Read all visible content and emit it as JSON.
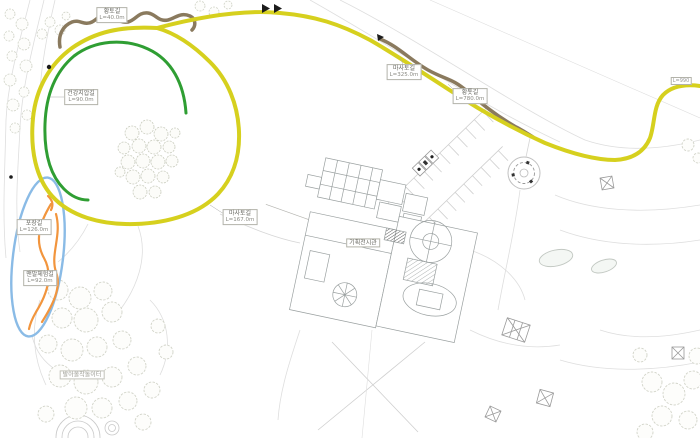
{
  "map": {
    "type": "park-trail-site-plan",
    "colors": {
      "trail_yellow": "#d6d01e",
      "trail_green": "#2f9e33",
      "trail_brown": "#8a7a5e",
      "trail_orange": "#f2953d",
      "track_blue": "#8abbe6"
    },
    "trails": [
      {
        "name": "황토길",
        "length": "L=40.0m"
      },
      {
        "name": "마사토길",
        "length": "L=325.0m"
      },
      {
        "name": "황톳길",
        "length": "L=780.0m"
      },
      {
        "name": "건강지압길",
        "length": "L=90.0m"
      },
      {
        "name": "마사토길",
        "length": "L=167.0m"
      },
      {
        "name": "포장길",
        "length": "L=126.0m"
      },
      {
        "name": "맨발체험길",
        "length": "L=92.0m"
      }
    ],
    "facilities": {
      "exhibition_hall": "기획전시관",
      "playground": "발아올작놀이터",
      "edge_label": "L=990"
    }
  }
}
